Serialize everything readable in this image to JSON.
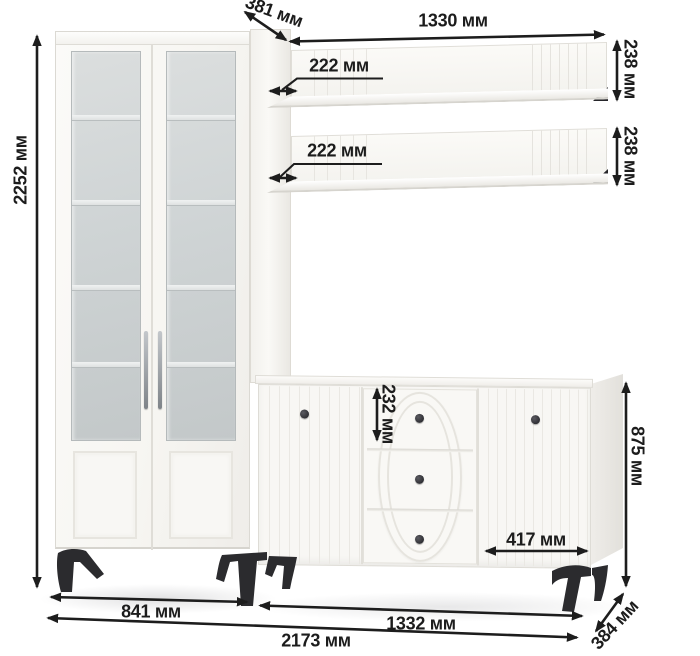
{
  "diagram": {
    "unit_suffix": "мм",
    "dims": {
      "total_height": "2252 мм",
      "upper_depth": "381 мм",
      "shelf_length": "1330 мм",
      "shelf_top_depth": "222 мм",
      "shelf_bottom_depth": "222 мм",
      "shelf_top_height": "238 мм",
      "shelf_bottom_height": "238 мм",
      "drawer_height": "232 мм",
      "sideboard_height": "875 мм",
      "sideboard_door_width": "417 мм",
      "cabinet_width": "841 мм",
      "sideboard_width": "1332 мм",
      "total_width": "2173 мм",
      "sideboard_depth": "384 мм"
    },
    "colors": {
      "annotation": "#1d1d1d",
      "furniture_white": "#f8f7f4",
      "glass": "#ced3d4",
      "hardware_dark": "#2b2b2e",
      "background": "#ffffff"
    }
  }
}
